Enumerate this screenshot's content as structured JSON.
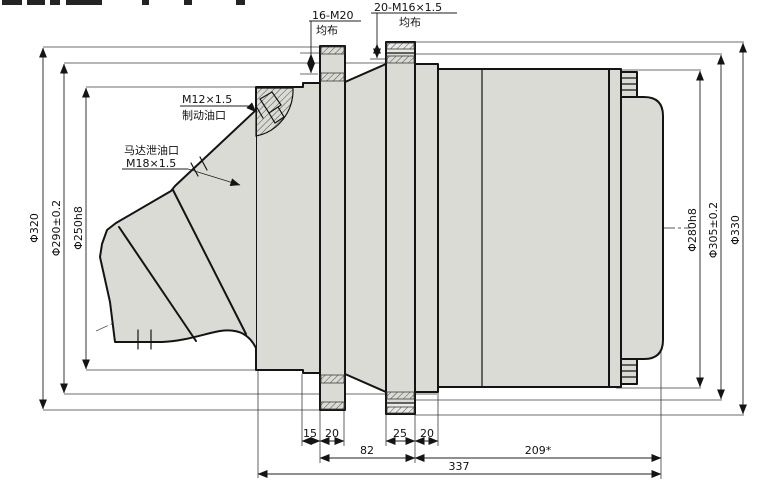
{
  "callouts": {
    "bolt_circle_front": {
      "title": "16-M20",
      "sub": "均布"
    },
    "bolt_circle_rear": {
      "title": "20-M16×1.5",
      "sub": "均布"
    },
    "brake_port": {
      "title": "M12×1.5",
      "sub": "制动油口"
    },
    "drain_port": {
      "title": "马达泄油口",
      "sub": "M18×1.5"
    }
  },
  "dims": {
    "left": [
      "Φ320",
      "Φ290±0.2",
      "Φ250h8"
    ],
    "right": [
      "Φ280h8",
      "Φ305±0.2",
      "Φ330"
    ],
    "widths": [
      "15",
      "20",
      "25",
      "20"
    ],
    "lengths": [
      "82",
      "209*"
    ],
    "total": "337"
  },
  "colors": {
    "body": "#dbdbd6",
    "body-light": "#eaeae6",
    "line": "#141414",
    "dim": "#1f1f1f",
    "cl": "#5a5a5a",
    "bg": "#ffffff"
  }
}
